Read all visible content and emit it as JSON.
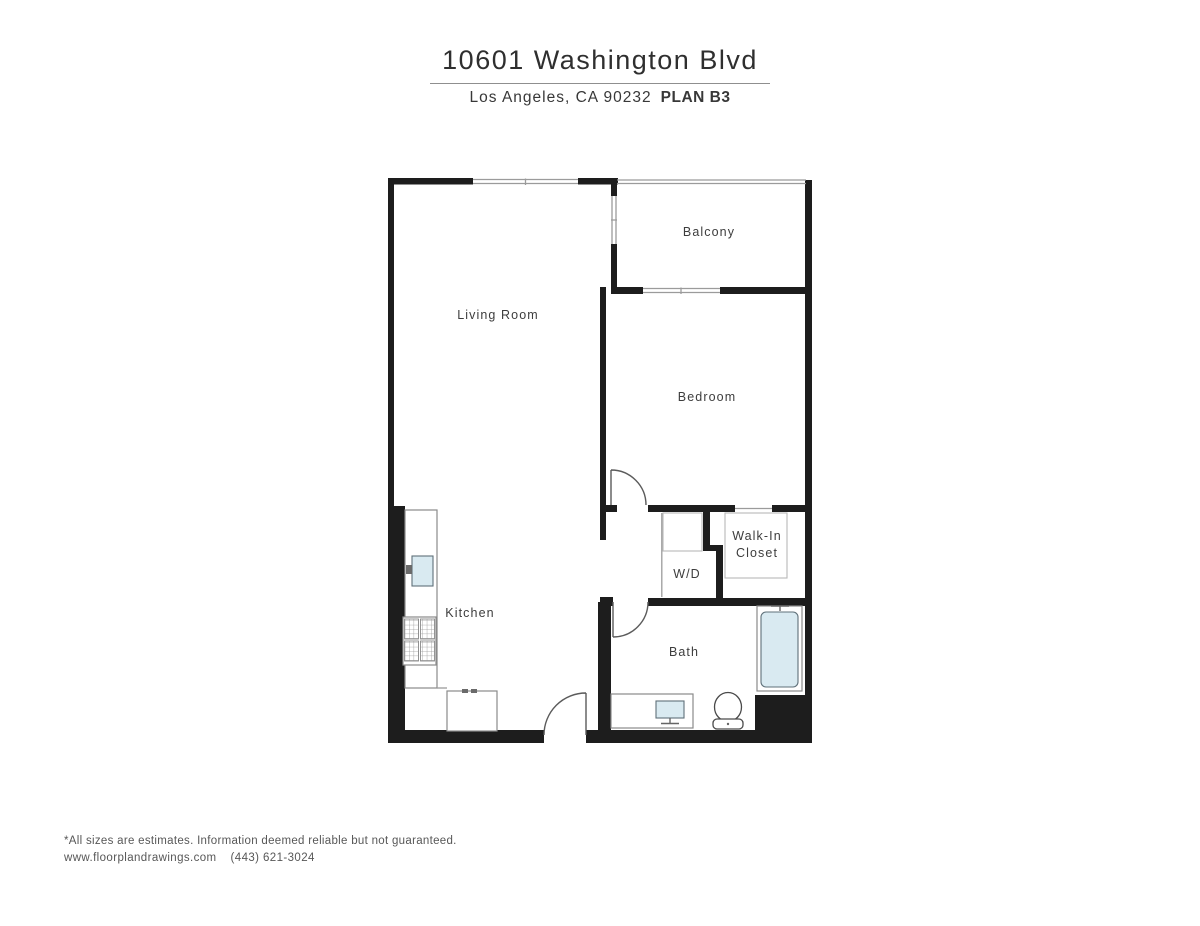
{
  "header": {
    "title": "10601 Washington Blvd",
    "location": "Los Angeles, CA 90232",
    "plan": "PLAN B3"
  },
  "rooms": {
    "living_room": "Living Room",
    "balcony": "Balcony",
    "bedroom": "Bedroom",
    "walk_in_closet_line1": "Walk-In",
    "walk_in_closet_line2": "Closet",
    "wd": "W/D",
    "kitchen": "Kitchen",
    "bath": "Bath"
  },
  "colors": {
    "wall": "#1d1d1d",
    "thin_line": "#9b9b9b",
    "fixture_outline": "#8a8a8a",
    "water_fill": "#d9eaf1",
    "label_text": "#3d3d3d"
  },
  "footer": {
    "disclaimer": "*All sizes are estimates. Information deemed reliable but not guaranteed.",
    "website": "www.floorplandrawings.com",
    "phone": "(443) 621-3024"
  }
}
